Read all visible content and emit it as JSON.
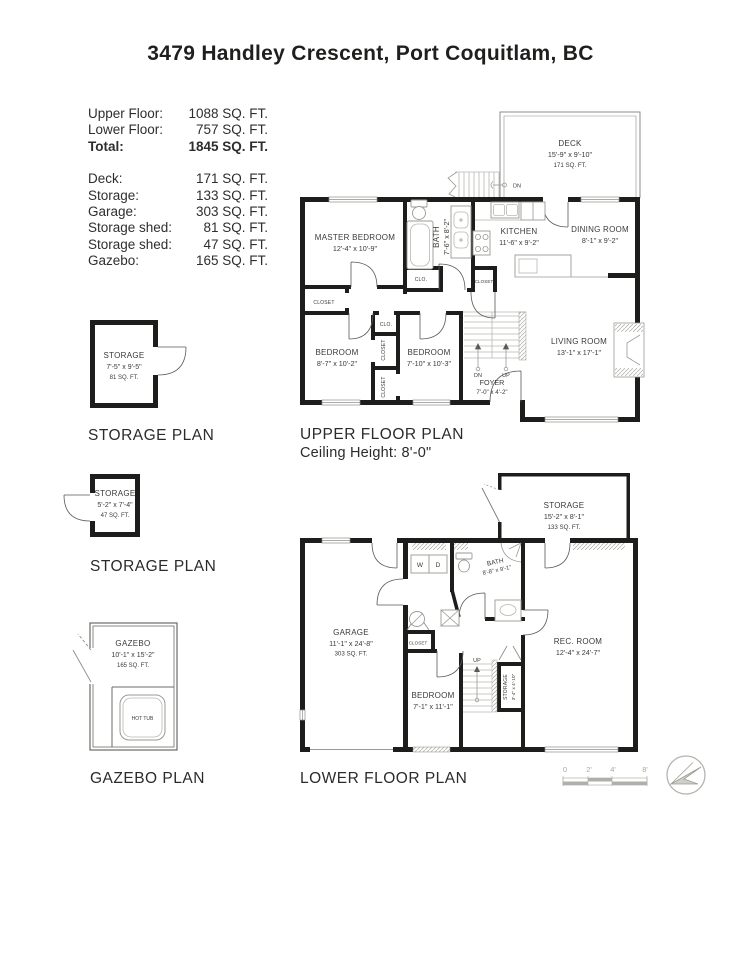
{
  "page": {
    "title": "3479 Handley Crescent, Port Coquitlam, BC"
  },
  "area_table": {
    "main_rows": [
      {
        "label": "Upper Floor:",
        "value": "1088 SQ. FT."
      },
      {
        "label": "Lower Floor:",
        "value": "757 SQ. FT."
      },
      {
        "label": "Total:",
        "value": "1845 SQ. FT."
      }
    ],
    "detail_rows": [
      {
        "label": "Deck:",
        "value": "171 SQ. FT."
      },
      {
        "label": "Storage:",
        "value": "133 SQ. FT."
      },
      {
        "label": "Garage:",
        "value": "303 SQ. FT."
      },
      {
        "label": "Storage shed:",
        "value": "81 SQ. FT."
      },
      {
        "label": "Storage shed:",
        "value": "47 SQ. FT."
      },
      {
        "label": "Gazebo:",
        "value": "165 SQ. FT."
      }
    ]
  },
  "upper_floor": {
    "caption": "UPPER FLOOR PLAN",
    "ceiling": "Ceiling Height: 8'-0\"",
    "deck": {
      "name": "DECK",
      "dims": "15'-9\" x 9'-10\"",
      "area": "171 SQ. FT."
    },
    "master_bedroom": {
      "name": "MASTER BEDROOM",
      "dims": "12'-4\" x 10'-9\""
    },
    "bath": {
      "name": "BATH",
      "dims": "7'-6\" x 8'-2\""
    },
    "kitchen": {
      "name": "KITCHEN",
      "dims": "11'-6\" x 9'-2\""
    },
    "dining_room": {
      "name": "DINING ROOM",
      "dims": "8'-1\" x 9'-2\""
    },
    "living_room": {
      "name": "LIVING ROOM",
      "dims": "13'-1\" x 17'-1\""
    },
    "bedroom_left": {
      "name": "BEDROOM",
      "dims": "8'-7\" x 10'-2\""
    },
    "bedroom_right": {
      "name": "BEDROOM",
      "dims": "7'-10\" x 10'-3\""
    },
    "foyer": {
      "name": "FOYER",
      "dims": "7'-0\" x 4'-2\""
    },
    "labels": {
      "closet": "CLOSET",
      "clo": "CLO.",
      "dn": "DN",
      "up": "UP"
    }
  },
  "lower_floor": {
    "caption": "LOWER FLOOR PLAN",
    "storage": {
      "name": "STORAGE",
      "dims": "15'-2\" x 8'-1\"",
      "area": "133 SQ. FT."
    },
    "garage": {
      "name": "GARAGE",
      "dims": "11'-1\" x 24'-8\"",
      "area": "303 SQ. FT."
    },
    "bath": {
      "name": "BATH",
      "dims": "8'-8\" x 9'-1\""
    },
    "bedroom": {
      "name": "BEDROOM",
      "dims": "7'-1\" x 11'-1\""
    },
    "rec_room": {
      "name": "REC. ROOM",
      "dims": "12'-4\" x 24'-7\""
    },
    "storage_small": {
      "name": "STORAGE",
      "dims": "3'-4\" x 4'-10\""
    },
    "labels": {
      "closet": "CLOSET",
      "up": "UP",
      "washer": "W",
      "dryer": "D"
    }
  },
  "storage_shed_large": {
    "caption": "STORAGE PLAN",
    "name": "STORAGE",
    "dims": "7'-5\" x 9'-5\"",
    "area": "81 SQ. FT."
  },
  "storage_shed_small": {
    "caption": "STORAGE PLAN",
    "name": "STORAGE",
    "dims": "5'-2\" x 7'-4\"",
    "area": "47 SQ. FT."
  },
  "gazebo": {
    "caption": "GAZEBO PLAN",
    "name": "GAZEBO",
    "dims": "10'-1\" x 15'-2\"",
    "area": "165 SQ. FT.",
    "hot_tub": "HOT TUB"
  },
  "scale_bar": {
    "ticks": [
      "0",
      "2'",
      "4'",
      "8'"
    ]
  },
  "colors": {
    "wall": "#1d1d1b",
    "label_text": "#3a3a38",
    "fixture": "#9a9a94",
    "muted": "#b0b0aa"
  }
}
